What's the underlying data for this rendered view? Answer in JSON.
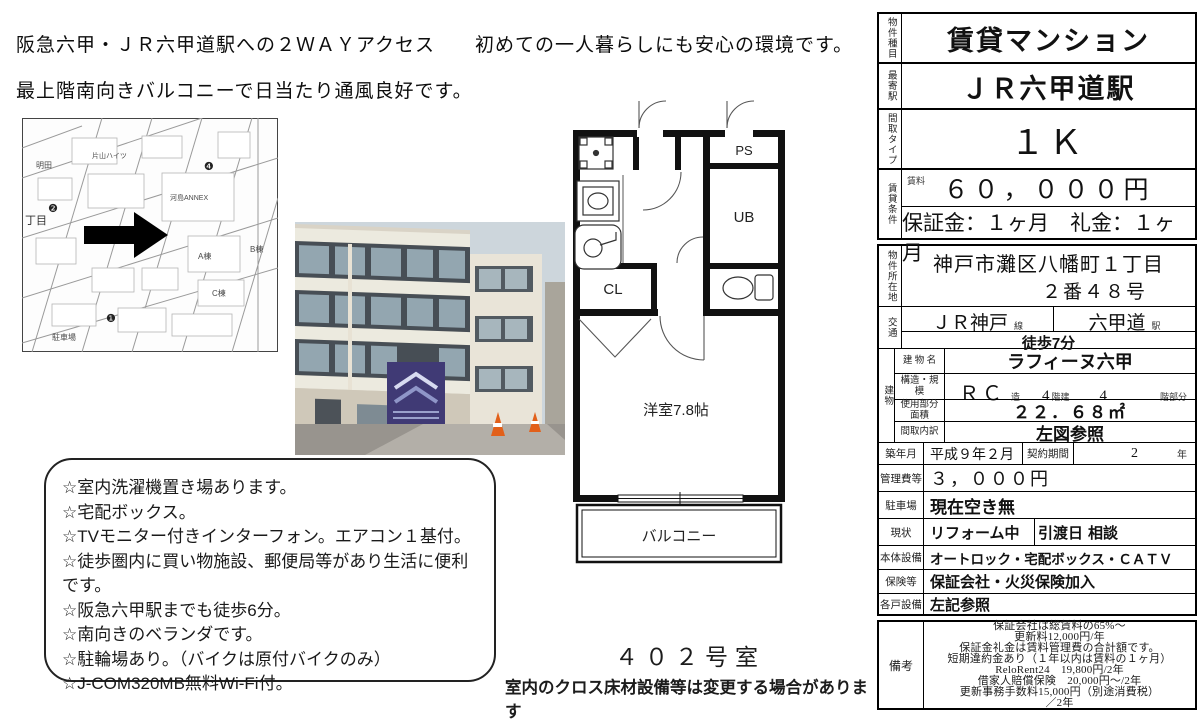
{
  "page": {
    "headline_line1": "阪急六甲・ＪＲ六甲道駅への２ＷＡＹアクセス　　初めての一人暮らしにも安心の環境です。",
    "headline_line2": "最上階南向きバルコニーで日当たり通風良好です。",
    "room_number": "４０２号室",
    "disclaimer": "室内のクロス床材設備等は変更する場合があります",
    "colors": {
      "ink": "#111111",
      "sign_purple": "#403a75",
      "cone_orange": "#e2601a"
    }
  },
  "features": {
    "items": [
      "☆室内洗濯機置き場あります。",
      "☆宅配ボックス。",
      "☆TVモニター付きインターフォン。エアコン１基付。",
      "☆徒歩圏内に買い物施設、郵便局等があり生活に便利です。",
      "☆阪急六甲駅までも徒歩6分。",
      "☆南向きのベランダです。",
      "☆駐輪場あり。（バイクは原付バイクのみ）",
      "☆J-COM320MB無料Wi-Fi付。"
    ]
  },
  "floorplan": {
    "ps": "PS",
    "ub": "UB",
    "cl": "CL",
    "room": "洋室7.8帖",
    "balcony": "バルコニー"
  },
  "map": {
    "labels": [
      "明田",
      "片山ハイツ",
      "河島ANNEX",
      "A棟",
      "B棟",
      "C棟",
      "駐車場",
      "丁目"
    ],
    "markers": [
      "❶",
      "❷",
      "❹"
    ]
  },
  "table": {
    "property_type_label": "物件種目",
    "property_type": "賃貸マンション",
    "nearest_station_label": "最寄駅",
    "nearest_station": "ＪＲ六甲道駅",
    "layout_type_label": "間取タイプ",
    "layout_type": "１Ｋ",
    "rent_section_label": "賃貸条件",
    "rent_label": "賃料",
    "rent": "６０，０００円",
    "deposit_line": "保証金：１ヶ月　礼金：１ヶ月",
    "location_label": "物件所在地",
    "location_line1": "神戸市灘区八幡町１丁目",
    "location_line2": "２番４８号",
    "transport_label": "交通",
    "line_name": "ＪＲ神戸",
    "line_suffix": "線",
    "station_name": "六甲道",
    "station_suffix": "駅",
    "walk": "徒歩7分",
    "building_label": "建物",
    "building_name_label": "建 物 名",
    "building_name": "ラフィーヌ六甲",
    "structure_label": "構造・規模",
    "structure": "ＲＣ",
    "structure_suffix": "造",
    "floors": "4",
    "floors_suffix": "階建",
    "floor_no": "4",
    "floor_suffix": "階部分",
    "area_label": "使用部分面積",
    "area": "２２．６８㎡",
    "layout_detail_label": "間取内訳",
    "layout_detail": "左図参照",
    "built_label": "築年月",
    "built": "平成９年２月",
    "contract_label": "契約期間",
    "contract": "2",
    "contract_suffix": "年",
    "fee_label": "管理費等",
    "fee": "３，０００円",
    "parking_label": "駐車場",
    "parking": "現在空き無",
    "status_label": "現状",
    "status": "リフォーム中",
    "handover_label": "引渡日",
    "handover": "相談",
    "equipment_label": "本体設備",
    "equipment": "オートロック・宅配ボックス・ＣＡＴＶ",
    "insurance_label": "保険等",
    "insurance": "保証会社・火災保険加入",
    "unit_equipment_label": "各戸設備",
    "unit_equipment": "左記参照",
    "remarks_label": "備考",
    "remarks_lines": [
      "保証会社は総賃料の65%～",
      "更新料12,000円/年",
      "保証金礼金は賃料管理費の合計額です。",
      "短期違約金あり（１年以内は賃料の１ヶ月）",
      "ReloRent24　19,800円/2年",
      "借家人賠償保険　20,000円～/2年",
      "更新事務手数料15,000円（別途消費税）",
      "／2年"
    ]
  }
}
